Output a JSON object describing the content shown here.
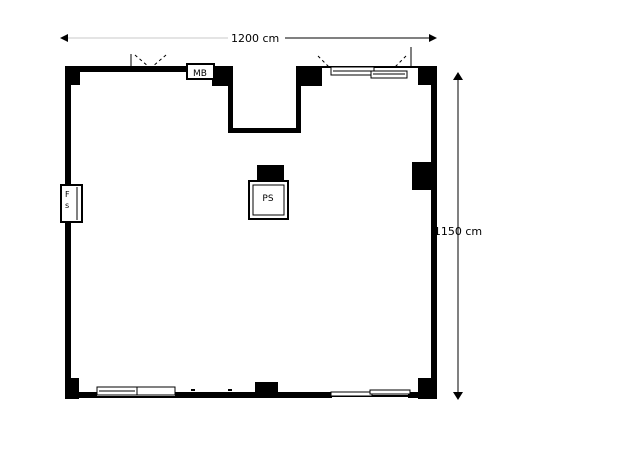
{
  "page": {
    "background_color": "#ffffff"
  },
  "plan": {
    "type": "floor-plan",
    "wall_color": "#000000",
    "faint_line_color": "#c9c9c9",
    "dimension_width": {
      "label": "1200 cm"
    },
    "dimension_height": {
      "label": "1150 cm"
    },
    "fixtures": {
      "mb_label": "MB",
      "ps_label": "PS",
      "fs_top_label": "F",
      "fs_bottom_label": "s"
    }
  }
}
